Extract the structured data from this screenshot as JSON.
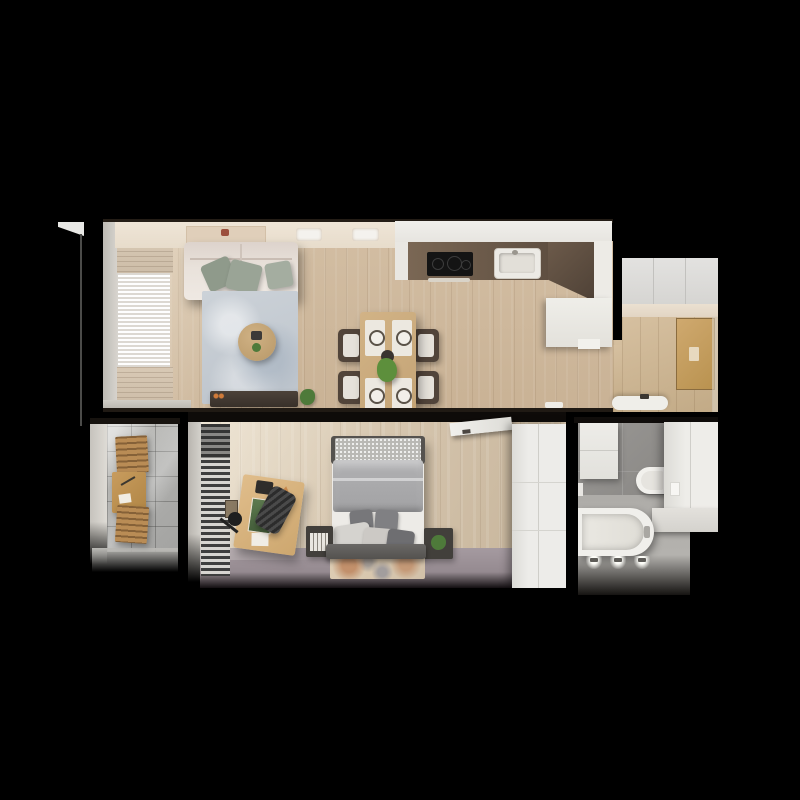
{
  "scene": {
    "type": "apartment floor plan, photorealistic top-down 3D render",
    "view": "top-down",
    "background_color": "#000000"
  },
  "palette": {
    "background": "#000000",
    "wood_floor": "#cdb79c",
    "wood_floor_bedroom": "#d6c7b0",
    "wood_floor_hall": "#c9b191",
    "wall_light": "#d6d3cd",
    "ceiling_cream": "#ece2d4",
    "sofa_cream": "#e8e1da",
    "pillow_sage": "#9aa396",
    "rug_blue_grey": "#c6ccd3",
    "kitchen_counter_white": "#edece8",
    "kitchen_backsplash_brown": "#6e5c4c",
    "cooktop_black": "#161616",
    "balcony_tile_grey": "#b4b4b0",
    "balcony_wood": "#b98c55",
    "bed_duvet_grey": "#a9a9ab",
    "carpet_mauve": "#9e9299",
    "bathroom_tile_grey": "#908e8b",
    "fixture_white": "#efeeea",
    "door_wood": "#c49e63",
    "plant_green": "#4e7a3a"
  },
  "rooms": {
    "living_room": {
      "name": "Living Room",
      "furniture": {
        "sofa": "Sofa with sage pillows",
        "rug": "Blue-grey rug",
        "coffee_table": "Round coffee table",
        "tv_bench": "TV bench",
        "dining_table": "Dining table for four",
        "dining_chair": "Rattan dining chair",
        "curtains": "Sheer curtains",
        "ceiling_shelf": "Wall shelf",
        "spotlight": "Ceiling light"
      }
    },
    "kitchen": {
      "name": "Kitchen",
      "furniture": {
        "counter": "L-shaped counter",
        "cooktop": "Induction cooktop",
        "sink": "Sink",
        "backsplash": "Dark backsplash"
      }
    },
    "hallway": {
      "name": "Entrance Hall",
      "furniture": {
        "wardrobe": "Built-in wardrobe",
        "entry_door": "Entry door",
        "bench": "White bench"
      }
    },
    "balcony": {
      "name": "Balcony",
      "furniture": {
        "table": "Folding wood table",
        "chair_upper": "Folding chair",
        "chair_lower": "Folding chair"
      }
    },
    "bedroom": {
      "name": "Bedroom",
      "furniture": {
        "bed": "Double bed",
        "headboard": "Headboard",
        "nightstand_left": "Nightstand with books",
        "nightstand_right": "Nightstand with plant",
        "rug": "Patterned rug",
        "desk": "Desk",
        "desk_chair": "Office chair",
        "desk_lamp": "Desk lamp",
        "blinds": "Window blinds",
        "wardrobe": "Wardrobe",
        "door": "Open room door"
      }
    },
    "bathroom": {
      "name": "Bathroom",
      "furniture": {
        "bathtub": "Bathtub",
        "toilet": "Wall-hung toilet",
        "vanity": "Vanity cabinet",
        "tall_cabinet": "Tall cabinet",
        "lights": "Wall lights"
      }
    }
  }
}
